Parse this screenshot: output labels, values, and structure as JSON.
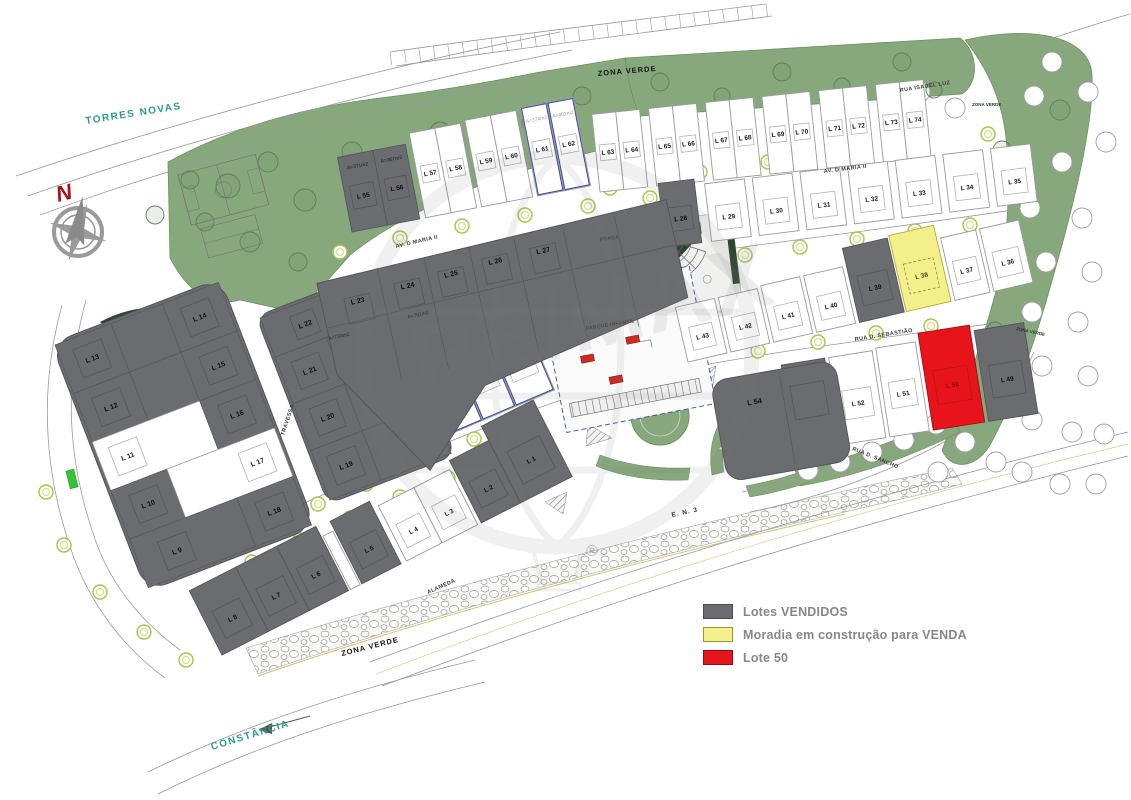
{
  "legend": {
    "items": [
      {
        "id": "sold",
        "label": "Lotes VENDIDOS",
        "color": "#6b6c6f",
        "border": "#4a4a4c"
      },
      {
        "id": "construction",
        "label": "Moradia em construção para VENDA",
        "color": "#f3ef8a",
        "border": "#9a9634"
      },
      {
        "id": "lote50",
        "label": "Lote 50",
        "color": "#e8141c",
        "border": "#8d0d12"
      }
    ]
  },
  "compass": {
    "label": "N"
  },
  "watermark": {
    "brand": "RE/MAX",
    "registered": "®"
  },
  "colors": {
    "green_zone": "#87a87c",
    "green_dark": "#2d452f",
    "road_line": "#9a9a9a",
    "teal_street": "#2e9894",
    "reserved_outline": "#3c4da0",
    "bright_green_marker": "#35c437",
    "status": {
      "sold": {
        "fill": "#6b6c6f",
        "stroke": "#55565a",
        "label": "#0d0d0d",
        "inner": "#56575a",
        "area": "#1c1c1c"
      },
      "free": {
        "fill": "#ffffff",
        "stroke": "#9b9b9b",
        "label": "#1a1a1a",
        "inner": "#b3b3b3",
        "area": "#9a9a9a"
      },
      "constr": {
        "fill": "#f3ef8a",
        "stroke": "#b0ab3e",
        "label": "#4a472a",
        "inner": "#8f8a3a",
        "area": "#8f8a3a"
      },
      "lote50": {
        "fill": "#e8141c",
        "stroke": "#a60d12",
        "label": "#7c0d10",
        "inner": "#b5161c",
        "area": "#7c0d10"
      }
    }
  },
  "street_labels": [
    {
      "t": "TORRES NOVAS",
      "x": 86,
      "y": 124,
      "r": -9,
      "k": "k-teal"
    },
    {
      "t": "CONSTÂNCIA",
      "x": 212,
      "y": 750,
      "r": -17,
      "k": "k-teal"
    },
    {
      "t": "ZONA VERDE",
      "x": 598,
      "y": 76,
      "r": -5,
      "k": "k-zone"
    },
    {
      "t": "ZONA VERDE",
      "x": 972,
      "y": 106,
      "r": 0,
      "k": "k-zone-sm"
    },
    {
      "t": "ZONA VERDE",
      "x": 1016,
      "y": 330,
      "r": 12,
      "k": "k-zone-sm"
    },
    {
      "t": "ZONA VERDE",
      "x": 342,
      "y": 656,
      "r": -14,
      "k": "k-zone"
    },
    {
      "t": "RUA ISABEL LUZ",
      "x": 900,
      "y": 92,
      "r": -9,
      "k": "k-street"
    },
    {
      "t": "AV. D MARIA II",
      "x": 396,
      "y": 248,
      "r": -13,
      "k": "k-street"
    },
    {
      "t": "AV. D MARIA II",
      "x": 824,
      "y": 173,
      "r": -7,
      "k": "k-street"
    },
    {
      "t": "RUA D. SEBASTIÃO",
      "x": 855,
      "y": 341,
      "r": -9,
      "k": "k-street"
    },
    {
      "t": "RUA D. SANCHO",
      "x": 852,
      "y": 450,
      "r": 22,
      "k": "k-street"
    },
    {
      "t": "TRAVESSA",
      "x": 284,
      "y": 436,
      "r": -72,
      "k": "k-street"
    },
    {
      "t": "ALAMEDA",
      "x": 428,
      "y": 594,
      "r": -24,
      "k": "k-street"
    },
    {
      "t": "E. N. 3",
      "x": 672,
      "y": 517,
      "r": -12,
      "k": "k-road"
    },
    {
      "t": "PRAÇA",
      "x": 600,
      "y": 241,
      "r": -7,
      "k": "k-tiny"
    },
    {
      "t": "PARQUE INFANTIL",
      "x": 586,
      "y": 330,
      "r": -9,
      "k": "k-tiny"
    }
  ],
  "map": {
    "rows": [
      {
        "id": "rua-isabel-luz-west",
        "x": 352,
        "y": 232,
        "rot": -11,
        "lots": [
          {
            "n": "L 55",
            "s": "sold",
            "w": 36,
            "h": 76,
            "area": "A=371m2"
          },
          {
            "n": "L 56",
            "s": "sold",
            "w": 33,
            "h": 76,
            "area": "A=367m2",
            "g": 6
          },
          {
            "n": "L 57",
            "s": "free",
            "w": 26,
            "h": 86
          },
          {
            "n": "L 58",
            "s": "free",
            "w": 26,
            "h": 86,
            "g": 5
          },
          {
            "n": "L 59",
            "s": "free",
            "w": 26,
            "h": 88
          },
          {
            "n": "L 60",
            "s": "free",
            "w": 26,
            "h": 88,
            "g": 5
          },
          {
            "n": "L 61",
            "s": "free",
            "w": 27,
            "h": 90,
            "o": 1,
            "area": "A=374m2"
          },
          {
            "n": "L 62",
            "s": "free",
            "w": 27,
            "h": 90,
            "o": 1,
            "area": "A=402m2"
          }
        ]
      },
      {
        "id": "rua-isabel-luz-east",
        "x": 600,
        "y": 192,
        "rot": -6,
        "lots": [
          {
            "n": "L 63",
            "s": "free",
            "w": 24,
            "h": 78
          },
          {
            "n": "L 64",
            "s": "free",
            "w": 24,
            "h": 78,
            "g": 9
          },
          {
            "n": "L 65",
            "s": "free",
            "w": 24,
            "h": 78
          },
          {
            "n": "L 66",
            "s": "free",
            "w": 24,
            "h": 78,
            "g": 9
          },
          {
            "n": "L 67",
            "s": "free",
            "w": 24,
            "h": 78
          },
          {
            "n": "L 68",
            "s": "free",
            "w": 24,
            "h": 78,
            "g": 9
          },
          {
            "n": "L 69",
            "s": "free",
            "w": 24,
            "h": 78
          },
          {
            "n": "L 70",
            "s": "free",
            "w": 24,
            "h": 78,
            "g": 9
          },
          {
            "n": "L 71",
            "s": "free",
            "w": 24,
            "h": 78
          },
          {
            "n": "L 72",
            "s": "free",
            "w": 24,
            "h": 78,
            "g": 9
          },
          {
            "n": "L 73",
            "s": "free",
            "w": 24,
            "h": 78
          },
          {
            "n": "L 74",
            "s": "free",
            "w": 24,
            "h": 78
          }
        ]
      },
      {
        "id": "av-maria-row-east",
        "x": 666,
        "y": 247,
        "rot": -7,
        "lots": [
          {
            "n": "L 28",
            "s": "sold",
            "w": 36,
            "h": 64,
            "g": 10
          },
          {
            "n": "L 29",
            "s": "free",
            "w": 40,
            "h": 58,
            "g": 8
          },
          {
            "n": "L 30",
            "s": "free",
            "w": 40,
            "h": 58,
            "g": 8
          },
          {
            "n": "L 31",
            "s": "free",
            "w": 40,
            "h": 58,
            "g": 8
          },
          {
            "n": "L 32",
            "s": "free",
            "w": 40,
            "h": 58,
            "g": 8
          },
          {
            "n": "L 33",
            "s": "free",
            "w": 40,
            "h": 58,
            "g": 8
          },
          {
            "n": "L 34",
            "s": "free",
            "w": 40,
            "h": 58,
            "g": 8
          },
          {
            "n": "L 35",
            "s": "free",
            "w": 40,
            "h": 58
          }
        ]
      },
      {
        "id": "central-strip-west",
        "x": 328,
        "y": 486,
        "rot": -23,
        "lots": [
          {
            "n": "L 48",
            "s": "sold",
            "w": 92,
            "h": 88,
            "g": 4
          },
          {
            "n": "L 47",
            "s": "free",
            "w": 36,
            "h": 78
          },
          {
            "n": "L 46",
            "s": "free",
            "w": 36,
            "h": 80,
            "o": 1
          },
          {
            "n": "L 45",
            "s": "free",
            "w": 36,
            "h": 82,
            "o": 1
          },
          {
            "n": "L 44",
            "s": "free",
            "w": 42,
            "h": 84,
            "o": 1,
            "area": "A=432m2"
          }
        ]
      },
      {
        "id": "central-strip-east",
        "x": 688,
        "y": 362,
        "rot": -13,
        "lots": [
          {
            "n": "L 43",
            "s": "free",
            "w": 40,
            "h": 56,
            "g": 4
          },
          {
            "n": "L 42",
            "s": "free",
            "w": 40,
            "h": 56,
            "g": 4
          },
          {
            "n": "L 41",
            "s": "free",
            "w": 40,
            "h": 58,
            "g": 4
          },
          {
            "n": "L 40",
            "s": "free",
            "w": 40,
            "h": 58,
            "g": 4
          },
          {
            "n": "L 39",
            "s": "sold",
            "w": 46,
            "h": 76,
            "g": 2
          },
          {
            "n": "L 38",
            "s": "constr",
            "w": 46,
            "h": 78,
            "g": 4
          },
          {
            "n": "L 37",
            "s": "free",
            "w": 36,
            "h": 64,
            "g": 4
          },
          {
            "n": "L 36",
            "s": "free",
            "w": 40,
            "h": 64
          }
        ]
      },
      {
        "id": "rua-sebastiao-row",
        "x": 795,
        "y": 452,
        "rot": -9,
        "lots": [
          {
            "n": "L 53",
            "s": "sold",
            "w": 44,
            "h": 88,
            "g": 4
          },
          {
            "n": "L 52",
            "s": "free",
            "w": 44,
            "h": 88,
            "g": 4
          },
          {
            "n": "L 51",
            "s": "free",
            "w": 40,
            "h": 90,
            "g": 4
          },
          {
            "n": "L 50",
            "s": "lote50",
            "w": 52,
            "h": 98,
            "g": 4
          },
          {
            "n": "L 49",
            "s": "sold",
            "w": 50,
            "h": 92
          }
        ]
      },
      {
        "id": "south-row",
        "x": 222,
        "y": 655,
        "rot": -27,
        "lots": [
          {
            "n": "L 8",
            "s": "sold",
            "w": 52,
            "h": 72
          },
          {
            "n": "L 7",
            "s": "sold",
            "w": 46,
            "h": 72
          },
          {
            "n": "L 6",
            "s": "sold",
            "w": 44,
            "h": 72,
            "g": 2
          },
          {
            "n": "",
            "s": "free",
            "w": 11,
            "h": 60,
            "g": 2
          },
          {
            "n": "L 5",
            "s": "sold",
            "w": 44,
            "h": 70,
            "g": 6
          },
          {
            "n": "L 4",
            "s": "free",
            "w": 40,
            "h": 62
          },
          {
            "n": "L 3",
            "s": "free",
            "w": 40,
            "h": 62,
            "g": 4
          },
          {
            "n": "L 2",
            "s": "sold",
            "w": 44,
            "h": 70
          },
          {
            "n": "L 1",
            "s": "sold",
            "w": 58,
            "h": 86
          }
        ]
      }
    ],
    "blocks": [
      {
        "id": "block-west",
        "x": 55,
        "y": 345,
        "rot": -21,
        "w": 175,
        "h": 260,
        "rx": 22,
        "cells": [
          {
            "n": "L 13",
            "x": 0,
            "y": 0,
            "w": 60,
            "h": 52
          },
          {
            "x": 60,
            "y": 0,
            "w": 55,
            "h": 52
          },
          {
            "n": "L 14",
            "x": 115,
            "y": 0,
            "w": 60,
            "h": 52
          },
          {
            "n": "L 12",
            "x": 0,
            "y": 52,
            "w": 60,
            "h": 52
          },
          {
            "x": 60,
            "y": 52,
            "w": 55,
            "h": 52
          },
          {
            "n": "L 15",
            "x": 115,
            "y": 52,
            "w": 60,
            "h": 52
          },
          {
            "n": "L 11",
            "s": "free",
            "x": 0,
            "y": 104,
            "w": 115,
            "h": 52,
            "lx": 28,
            "ly": 130
          },
          {
            "n": "L 16",
            "x": 115,
            "y": 104,
            "w": 60,
            "h": 52
          },
          {
            "n": "L 10",
            "x": 0,
            "y": 156,
            "w": 60,
            "h": 52
          },
          {
            "n": "L 17",
            "s": "free",
            "x": 60,
            "y": 156,
            "w": 115,
            "h": 52,
            "lx": 147,
            "ly": 182
          },
          {
            "n": "L 9",
            "x": 0,
            "y": 208,
            "w": 115,
            "h": 52,
            "lx": 40,
            "ly": 236
          },
          {
            "n": "L 18",
            "x": 115,
            "y": 208,
            "w": 60,
            "h": 52
          }
        ]
      },
      {
        "id": "block-center-west",
        "x": 260,
        "y": 318,
        "rot": -21,
        "w": 130,
        "h": 195,
        "rx": 14,
        "cells": [
          {
            "n": "L 22",
            "x": 0,
            "y": 0,
            "w": 130,
            "h": 42,
            "lx": 40,
            "ly": 22
          },
          {
            "n": "L 21",
            "x": 0,
            "y": 42,
            "w": 55,
            "h": 50
          },
          {
            "x": 55,
            "y": 42,
            "w": 75,
            "h": 50
          },
          {
            "n": "L 20",
            "x": 0,
            "y": 92,
            "w": 55,
            "h": 50
          },
          {
            "x": 55,
            "y": 92,
            "w": 75,
            "h": 50
          },
          {
            "n": "L 19",
            "x": 0,
            "y": 142,
            "w": 55,
            "h": 53
          },
          {
            "x": 55,
            "y": 142,
            "w": 75,
            "h": 53
          }
        ]
      }
    ],
    "central_block": {
      "id": "block-central",
      "x": 285,
      "y": 315,
      "rot": -12.5,
      "poly": "M38,-24 L397,-30 L397,70 L180,112 L108,183 L38,70 Z",
      "dividers": [
        100,
        148,
        194,
        240,
        290,
        343
      ],
      "labels": [
        {
          "n": "L 23",
          "x": 74,
          "y": 2
        },
        {
          "n": "L 24",
          "x": 126,
          "y": -2
        },
        {
          "n": "L 25",
          "x": 171,
          "y": -4
        },
        {
          "n": "L 26",
          "x": 217,
          "y": -7
        },
        {
          "n": "L 27",
          "x": 266,
          "y": -7
        }
      ],
      "areas": [
        {
          "t": "A=730m2",
          "x": 48,
          "y": 34
        },
        {
          "t": "A=701m2",
          "x": 130,
          "y": 30
        }
      ]
    },
    "big_lots": [
      {
        "id": "lot-l-54",
        "n": "L 54",
        "s": "sold",
        "x": 728,
        "y": 482,
        "rot": -10,
        "w": 126,
        "h": 102,
        "rx": 16,
        "lx": 40,
        "ly": -72
      }
    ]
  }
}
